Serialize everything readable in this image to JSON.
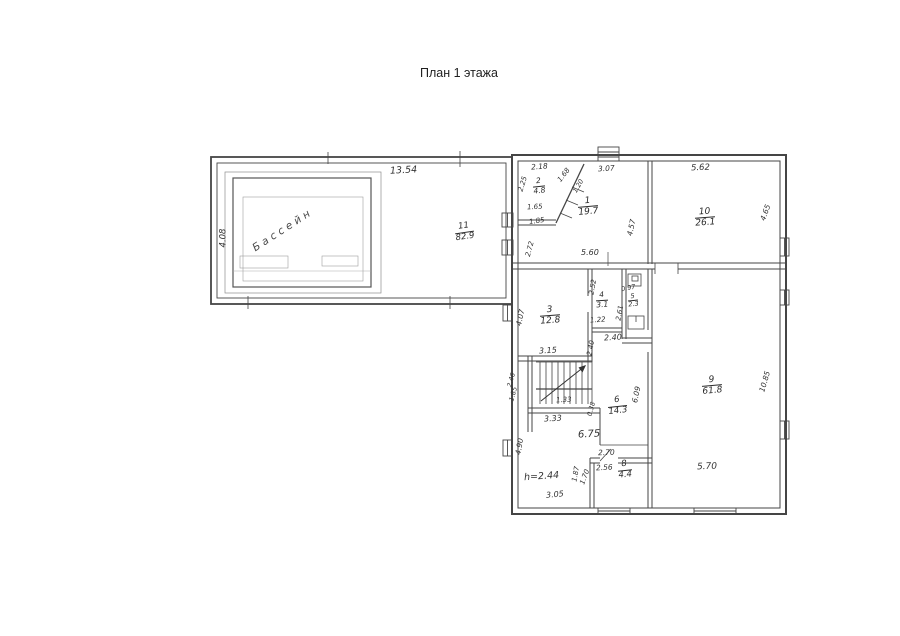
{
  "title": "План 1 этажа",
  "ink": "#454545",
  "pool": {
    "name": "Бассейн"
  },
  "rooms": {
    "r1": {
      "no": "1",
      "area": "19.7"
    },
    "r2": {
      "no": "2",
      "area": "4.8"
    },
    "r3": {
      "no": "3",
      "area": "12.8"
    },
    "r4": {
      "no": "4",
      "area": "3.1"
    },
    "r5": {
      "no": "5",
      "area": "2.3"
    },
    "r6": {
      "no": "6",
      "area": "14.3"
    },
    "r8": {
      "no": "8",
      "area": "4.4"
    },
    "r9": {
      "no": "9",
      "area": "61.8"
    },
    "r10": {
      "no": "10",
      "area": "26.1"
    },
    "r11": {
      "no": "11",
      "area": "82.9"
    },
    "hroom": {
      "label": "h=2.44"
    }
  },
  "dims": {
    "pool_width": "13.54",
    "pool_depth": "4.08",
    "d218": "2.18",
    "d225": "2.25",
    "d168": "1.68",
    "d120": "1.20",
    "d307": "3.07",
    "d165": "1.65",
    "d185": "1.85",
    "d457": "4.57",
    "d560": "5.60",
    "d272": "2.72",
    "d562": "5.62",
    "d465": "4.65",
    "d407": "4.07",
    "d315": "3.15",
    "d252": "2.52",
    "d122": "1.22",
    "d097": "0.97",
    "d261": "2.61",
    "d240a": "2.40",
    "d240b": "2.40",
    "d246": "2.46",
    "d185b": "1.85",
    "d133": "1.33",
    "d333": "3.33",
    "d038": "0.38",
    "d675": "6.75",
    "d609": "6.09",
    "d490": "4.90",
    "d305": "3.05",
    "d270": "2.70",
    "d256": "2.56",
    "d187": "1.87",
    "d170": "1.70",
    "d570": "5.70",
    "d1085": "10.85"
  }
}
